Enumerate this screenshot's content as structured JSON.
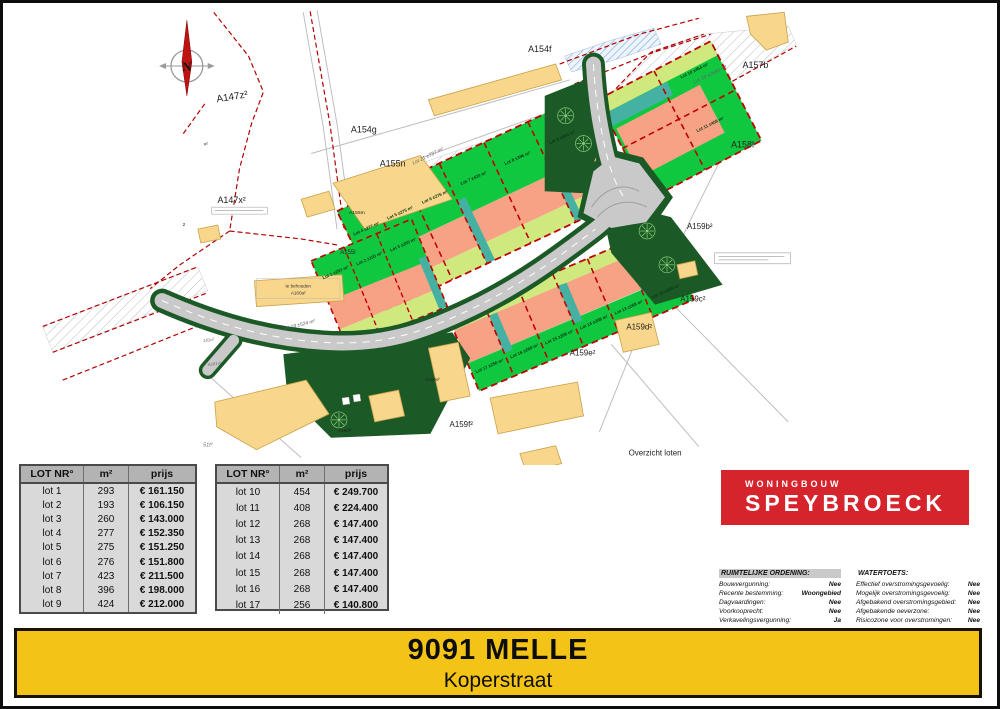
{
  "map": {
    "caption": "Overzicht loten",
    "compass_letter": "N",
    "labels": [
      {
        "text": "A154f",
        "x": 540,
        "y": 48,
        "size": 9,
        "cls": "parcel"
      },
      {
        "text": "A157b",
        "x": 757,
        "y": 64,
        "size": 9,
        "cls": "parcel"
      },
      {
        "text": "A147z²",
        "x": 231,
        "y": 96,
        "size": 10,
        "rot": -9,
        "cls": "parcel"
      },
      {
        "text": "A154g",
        "x": 363,
        "y": 129,
        "size": 9,
        "cls": "parcel"
      },
      {
        "text": "A155n",
        "x": 392,
        "y": 163,
        "size": 9,
        "cls": "parcel"
      },
      {
        "text": "A158l",
        "x": 744,
        "y": 144,
        "size": 9,
        "cls": "parcel"
      },
      {
        "text": "A147x²",
        "x": 230,
        "y": 200,
        "size": 9,
        "cls": "parcel"
      },
      {
        "text": "A155m",
        "x": 356,
        "y": 211,
        "size": 5,
        "cls": "parcel"
      },
      {
        "text": "A155l",
        "x": 347,
        "y": 251,
        "size": 6,
        "cls": "parcel"
      },
      {
        "text": "A159b²",
        "x": 701,
        "y": 226,
        "size": 8,
        "cls": "parcel"
      },
      {
        "text": "A159c²",
        "x": 694,
        "y": 299,
        "size": 8,
        "cls": "parcel"
      },
      {
        "text": "A159d²",
        "x": 640,
        "y": 327,
        "size": 8,
        "cls": "parcel"
      },
      {
        "text": "A159e²",
        "x": 583,
        "y": 353,
        "size": 8,
        "cls": "parcel"
      },
      {
        "text": "A159f²",
        "x": 461,
        "y": 425,
        "size": 8,
        "cls": "parcel"
      },
      {
        "text": "A160f²",
        "x": 344,
        "y": 430,
        "size": 4.5,
        "cls": "parcel"
      },
      {
        "text": "A160x²",
        "x": 432,
        "y": 379,
        "size": 4.5,
        "cls": "parcel"
      },
      {
        "text": "v²",
        "x": 204,
        "y": 142,
        "size": 5,
        "cls": "parcel"
      },
      {
        "text": "2",
        "x": 182,
        "y": 223,
        "size": 5,
        "cls": "parcel"
      },
      {
        "text": "51t²",
        "x": 206,
        "y": 445,
        "size": 5.5,
        "cls": "tiny"
      },
      {
        "text": "161u²",
        "x": 207,
        "y": 339,
        "size": 4.3,
        "rot": -8,
        "cls": "tiny"
      },
      {
        "text": "A161v²",
        "x": 213,
        "y": 363,
        "size": 4.3,
        "rot": -8,
        "cls": "tiny"
      },
      {
        "text": "te behouden",
        "x": 297,
        "y": 285,
        "size": 4.6,
        "cls": "note"
      },
      {
        "text": "A160a²",
        "x": 297,
        "y": 292,
        "size": 4.6,
        "cls": "note"
      },
      {
        "text": "Overzicht loten",
        "x": 656,
        "y": 454,
        "size": 8,
        "cls": "parcel"
      },
      {
        "text": "N",
        "x": 185,
        "y": 67,
        "size": 13,
        "cls": "north"
      }
    ],
    "lot_labels": [
      {
        "text": "Lot 1 ±293 m²",
        "x": 335,
        "y": 271,
        "size": 4.4,
        "rot": -24,
        "cls": "lot"
      },
      {
        "text": "Lot 2 ±193 m²",
        "x": 369,
        "y": 257,
        "size": 4.4,
        "rot": -24,
        "cls": "lot"
      },
      {
        "text": "Lot 3 ±260 m²",
        "x": 403,
        "y": 243,
        "size": 4.4,
        "rot": -24,
        "cls": "lot"
      },
      {
        "text": "Lot 4 ±277 m²",
        "x": 366,
        "y": 227,
        "size": 4.4,
        "rot": -24,
        "cls": "lot"
      },
      {
        "text": "Lot 5 ±275 m²",
        "x": 400,
        "y": 211,
        "size": 4.4,
        "rot": -24,
        "cls": "lot"
      },
      {
        "text": "Lot 6 ±276 m²",
        "x": 435,
        "y": 195,
        "size": 4.4,
        "rot": -24,
        "cls": "lot"
      },
      {
        "text": "Lot 7 ±423 m²",
        "x": 474,
        "y": 176,
        "size": 4.4,
        "rot": -24,
        "cls": "lot"
      },
      {
        "text": "Lot 8 ±396 m²",
        "x": 518,
        "y": 156,
        "size": 4.4,
        "rot": -24,
        "cls": "lot"
      },
      {
        "text": "Lot 9 ±424 m²",
        "x": 563,
        "y": 135,
        "size": 4.4,
        "rot": -24,
        "cls": "lot"
      },
      {
        "text": "Lot 10 ±454 m²",
        "x": 696,
        "y": 68,
        "size": 4.4,
        "rot": -26,
        "cls": "lot"
      },
      {
        "text": "Lot 11 ±408 m²",
        "x": 712,
        "y": 122,
        "size": 4.4,
        "rot": -26,
        "cls": "lot"
      },
      {
        "text": "Lot 12 ±268 m²",
        "x": 667,
        "y": 290,
        "size": 4.4,
        "rot": -24,
        "cls": "lot"
      },
      {
        "text": "Lot 13 ±268 m²",
        "x": 630,
        "y": 306,
        "size": 4.4,
        "rot": -24,
        "cls": "lot"
      },
      {
        "text": "Lot 14 ±268 m²",
        "x": 595,
        "y": 321,
        "size": 4.4,
        "rot": -24,
        "cls": "lot"
      },
      {
        "text": "Lot 15 ±268 m²",
        "x": 560,
        "y": 336,
        "size": 4.4,
        "rot": -24,
        "cls": "lot"
      },
      {
        "text": "Lot 16 ±268 m²",
        "x": 525,
        "y": 350,
        "size": 4.4,
        "rot": -24,
        "cls": "lot"
      },
      {
        "text": "Lot 17 ±256 m²",
        "x": 490,
        "y": 365,
        "size": 4.4,
        "rot": -24,
        "cls": "lot"
      },
      {
        "text": "Lot 18 ±524 m²",
        "x": 298,
        "y": 324,
        "size": 5,
        "rot": -14,
        "cls": "lotw"
      },
      {
        "text": "Lot 19 ±1690 m²",
        "x": 712,
        "y": 72,
        "size": 5,
        "rot": -26,
        "cls": "lotw"
      },
      {
        "text": "Lot 21 ±737 m²",
        "x": 428,
        "y": 154,
        "size": 5,
        "rot": -26,
        "cls": "lotw"
      }
    ]
  },
  "tables": [
    {
      "headers": [
        "LOT NR°",
        "m²",
        "prijs"
      ],
      "rows": [
        {
          "lot": "lot 1",
          "m2": "293",
          "prijs": "€ 161.150"
        },
        {
          "lot": "lot 2",
          "m2": "193",
          "prijs": "€ 106.150"
        },
        {
          "lot": "lot 3",
          "m2": "260",
          "prijs": "€ 143.000"
        },
        {
          "lot": "lot 4",
          "m2": "277",
          "prijs": "€ 152.350"
        },
        {
          "lot": "lot 5",
          "m2": "275",
          "prijs": "€ 151.250"
        },
        {
          "lot": "lot 6",
          "m2": "276",
          "prijs": "€ 151.800"
        },
        {
          "lot": "lot 7",
          "m2": "423",
          "prijs": "€ 211.500"
        },
        {
          "lot": "lot 8",
          "m2": "396",
          "prijs": "€ 198.000"
        },
        {
          "lot": "lot 9",
          "m2": "424",
          "prijs": "€ 212.000"
        }
      ]
    },
    {
      "headers": [
        "LOT NR°",
        "m²",
        "prijs"
      ],
      "rows": [
        {
          "lot": "lot 10",
          "m2": "454",
          "prijs": "€ 249.700"
        },
        {
          "lot": "lot 11",
          "m2": "408",
          "prijs": "€ 224.400"
        },
        {
          "lot": "lot 12",
          "m2": "268",
          "prijs": "€ 147.400"
        },
        {
          "lot": "lot 13",
          "m2": "268",
          "prijs": "€ 147.400"
        },
        {
          "lot": "lot 14",
          "m2": "268",
          "prijs": "€ 147.400"
        },
        {
          "lot": "lot 15",
          "m2": "268",
          "prijs": "€ 147.400"
        },
        {
          "lot": "lot 16",
          "m2": "268",
          "prijs": "€ 147.400"
        },
        {
          "lot": "lot 17",
          "m2": "256",
          "prijs": "€ 140.800"
        }
      ]
    }
  ],
  "logo": {
    "line1": "WONINGBOUW",
    "line2": "SPEYBROECK"
  },
  "legend": {
    "left": {
      "title": "RUIMTELIJKE ORDENING:",
      "rows": [
        {
          "label": "Bouwvergunning:",
          "value": "Nee"
        },
        {
          "label": "Recente bestemming:",
          "value": "Woongebied"
        },
        {
          "label": "Dagvaardingen:",
          "value": "Nee"
        },
        {
          "label": "Voorkooprecht:",
          "value": "Nee"
        },
        {
          "label": "Verkavelingsvergunning:",
          "value": "Ja"
        }
      ]
    },
    "right": {
      "title": "WATERTOETS:",
      "rows": [
        {
          "label": "Effectief overstromingsgevoelig:",
          "value": "Nee"
        },
        {
          "label": "Mogelijk overstromingsgevoelig:",
          "value": "Nee"
        },
        {
          "label": "Afgebakend overstromingsgebied:",
          "value": "Nee"
        },
        {
          "label": "Afgebakende oeverzone:",
          "value": "Nee"
        },
        {
          "label": "Risicozone voor overstromingen:",
          "value": "Nee"
        }
      ]
    }
  },
  "banner": {
    "title": "9091 MELLE",
    "subtitle": "Koperstraat"
  },
  "colors": {
    "lot_green": "#10c840",
    "footprint_salmon": "#f7a285",
    "hedge_teal": "#45b1a2",
    "verge_lime": "#cfe97e",
    "buffer_dark_green": "#1b5a26",
    "road_gray": "#c9c9c9",
    "building_tan": "#f8d68c",
    "cadastral_red": "#b00000",
    "logo_red": "#d6242d",
    "banner_yellow": "#f3c417"
  }
}
